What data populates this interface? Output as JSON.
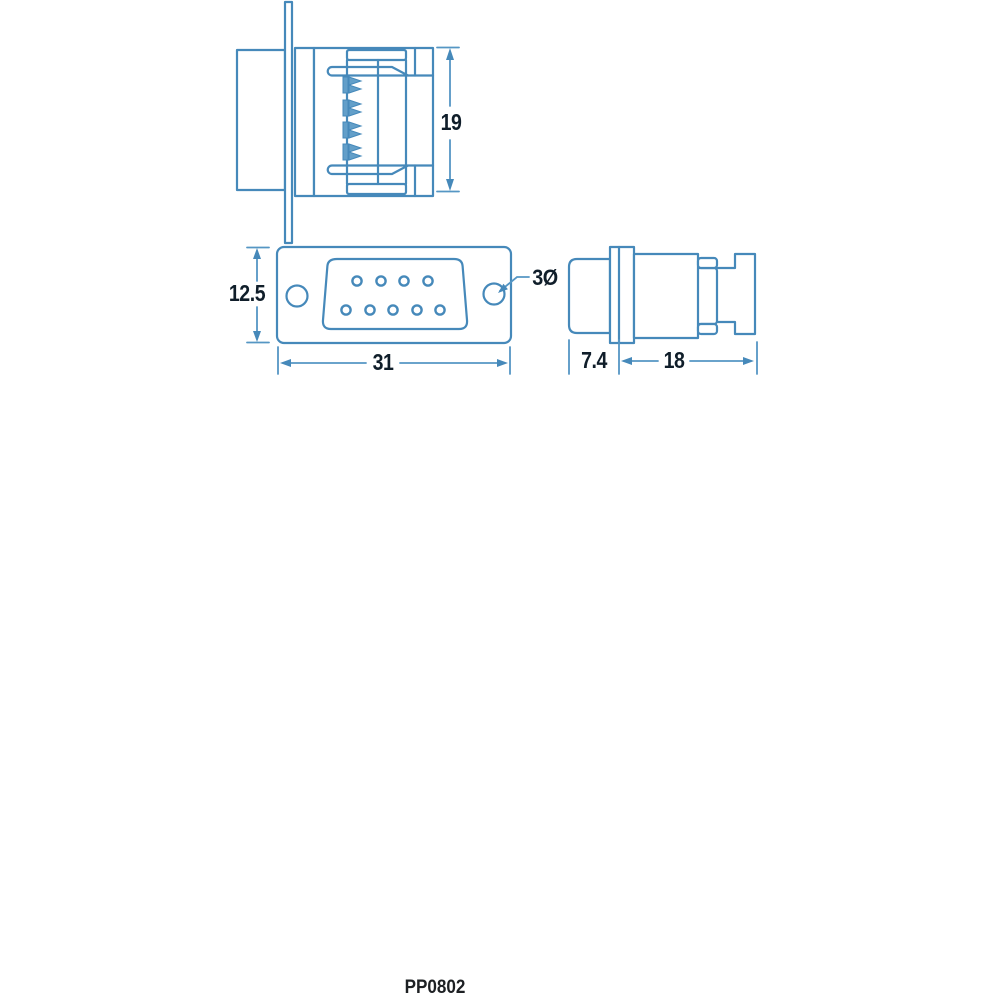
{
  "drawing": {
    "part_number": "PP0802",
    "colors": {
      "line_blue": "#4689ba",
      "dimension_line_blue": "#5596c4",
      "pin_contact_fill": "#639fc9",
      "dimension_text": "#101e2a",
      "part_number_text": "#1d2023",
      "background": "#ffffff"
    },
    "views": {
      "top_section": {
        "dimensions": {
          "height": "19"
        },
        "contact_count": 4
      },
      "front": {
        "dimensions": {
          "height": "12.5",
          "width": "31",
          "mounting_hole_diameter": "3Ø"
        },
        "pin_rows": {
          "top": 4,
          "bottom": 5
        },
        "mounting_holes": 2
      },
      "side": {
        "dimensions": {
          "shell_depth": "7.4",
          "body_depth": "18"
        }
      }
    }
  }
}
